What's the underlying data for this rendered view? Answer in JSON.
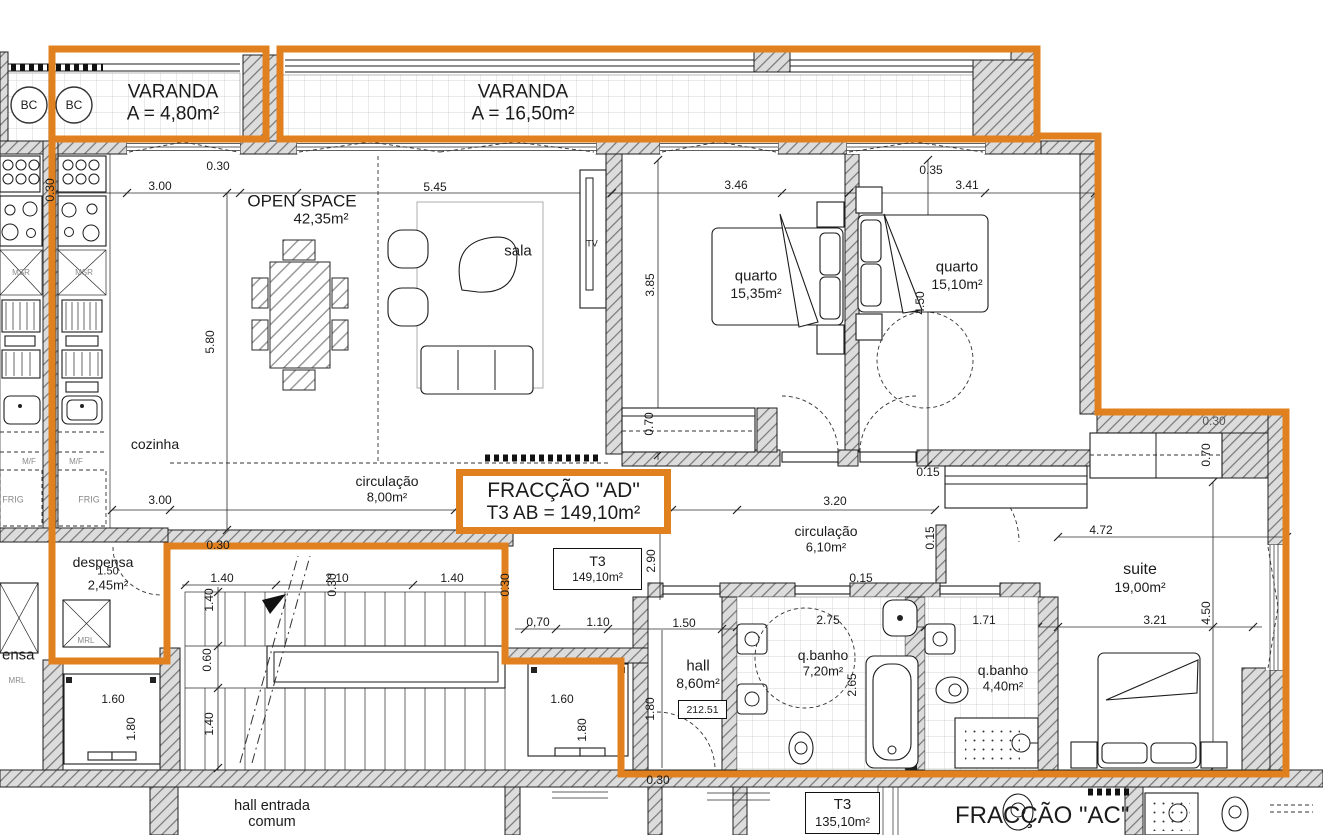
{
  "drawing": {
    "type": "apartment floor plan",
    "fraction_ad": {
      "line1": "FRACÇÃO \"AD\"",
      "line2": "T3  AB = 149,10m²"
    },
    "t3_tag": {
      "line1": "T3",
      "line2": "149,10m²"
    },
    "t3_lower_tag": {
      "line1": "T3",
      "line2": "135,10m²"
    },
    "level_mark": "212.51",
    "fraccao_ac": "FRACÇÃO \"AC\"",
    "common_hall": {
      "line1": "hall entrada",
      "line2": "comum"
    },
    "colors": {
      "boundary_orange": "#e0801f",
      "wall_hatch": "#dcdcdc",
      "line": "#1c1c1c"
    }
  },
  "labels": [
    {
      "id": "varanda-left-name",
      "text": "VARANDA",
      "x": 173,
      "y": 92,
      "size": 19
    },
    {
      "id": "varanda-left-area",
      "text": "A = 4,80m²",
      "x": 173,
      "y": 114,
      "size": 19
    },
    {
      "id": "varanda-main-name",
      "text": "VARANDA",
      "x": 523,
      "y": 92,
      "size": 19
    },
    {
      "id": "varanda-main-area",
      "text": "A = 16,50m²",
      "x": 523,
      "y": 114,
      "size": 19
    },
    {
      "id": "open-space-name",
      "text": "OPEN SPACE",
      "x": 302,
      "y": 201,
      "size": 17
    },
    {
      "id": "open-space-area",
      "text": "42,35m²",
      "x": 321,
      "y": 219,
      "size": 15
    },
    {
      "id": "sala-label",
      "text": "sala",
      "x": 518,
      "y": 251,
      "size": 15
    },
    {
      "id": "tv-label",
      "text": "TV",
      "x": 592,
      "y": 244,
      "size": 9
    },
    {
      "id": "quarto1-name",
      "text": "quarto",
      "x": 756,
      "y": 276,
      "size": 15
    },
    {
      "id": "quarto1-area",
      "text": "15,35m²",
      "x": 756,
      "y": 293,
      "size": 14
    },
    {
      "id": "quarto2-name",
      "text": "quarto",
      "x": 957,
      "y": 267,
      "size": 15
    },
    {
      "id": "quarto2-area",
      "text": "15,10m²",
      "x": 957,
      "y": 284,
      "size": 14
    },
    {
      "id": "cozinha-label",
      "text": "cozinha",
      "x": 155,
      "y": 444,
      "size": 14
    },
    {
      "id": "circulacao1-name",
      "text": "circulação",
      "x": 387,
      "y": 481,
      "size": 14
    },
    {
      "id": "circulacao1-area",
      "text": "8,00m²",
      "x": 387,
      "y": 497,
      "size": 13
    },
    {
      "id": "circulacao2-name",
      "text": "circulação",
      "x": 826,
      "y": 531,
      "size": 14
    },
    {
      "id": "circulacao2-area",
      "text": "6,10m²",
      "x": 826,
      "y": 547,
      "size": 13
    },
    {
      "id": "despensa-name",
      "text": "despensa",
      "x": 103,
      "y": 562,
      "size": 14
    },
    {
      "id": "despensa-area",
      "text": "2,45m²",
      "x": 108,
      "y": 585,
      "size": 13
    },
    {
      "id": "despensa-neighbor",
      "text": "ensa",
      "x": 2,
      "y": 655,
      "size": 15,
      "anchor": "left"
    },
    {
      "id": "hall-name",
      "text": "hall",
      "x": 698,
      "y": 666,
      "size": 15
    },
    {
      "id": "hall-area",
      "text": "8,60m²",
      "x": 698,
      "y": 683,
      "size": 14
    },
    {
      "id": "banho1-name",
      "text": "q.banho",
      "x": 823,
      "y": 655,
      "size": 14
    },
    {
      "id": "banho1-area",
      "text": "7,20m²",
      "x": 823,
      "y": 671,
      "size": 13
    },
    {
      "id": "banho2-name",
      "text": "q.banho",
      "x": 1003,
      "y": 670,
      "size": 14
    },
    {
      "id": "banho2-area",
      "text": "4,40m²",
      "x": 1003,
      "y": 686,
      "size": 13
    },
    {
      "id": "suite-name",
      "text": "suite",
      "x": 1140,
      "y": 570,
      "size": 16
    },
    {
      "id": "suite-area",
      "text": "19,00m²",
      "x": 1140,
      "y": 587,
      "size": 14
    },
    {
      "id": "bc-circle-left-label",
      "text": "BC",
      "x": 29,
      "y": 105,
      "size": 12
    },
    {
      "id": "bc-circle-right-label",
      "text": "BC",
      "x": 74,
      "y": 105,
      "size": 12
    },
    {
      "id": "mrl-label-1",
      "text": "MRL",
      "x": 86,
      "y": 641,
      "size": 8,
      "color": "#8a8a8a"
    },
    {
      "id": "mrl-label-2",
      "text": "MRL",
      "x": 17,
      "y": 681,
      "size": 8,
      "color": "#8a8a8a"
    },
    {
      "id": "msr-label-1",
      "text": "MSR",
      "x": 84,
      "y": 273,
      "size": 8,
      "color": "#8a8a8a"
    },
    {
      "id": "msr-label-2",
      "text": "MSR",
      "x": 21,
      "y": 273,
      "size": 8,
      "color": "#8a8a8a"
    },
    {
      "id": "mf-label-1",
      "text": "M/F",
      "x": 76,
      "y": 462,
      "size": 8,
      "color": "#8a8a8a"
    },
    {
      "id": "mf-label-2",
      "text": "M/F",
      "x": 29,
      "y": 462,
      "size": 8,
      "color": "#8a8a8a"
    },
    {
      "id": "frig-label-1",
      "text": "FRIG",
      "x": 89,
      "y": 500,
      "size": 9,
      "color": "#8a8a8a"
    },
    {
      "id": "frig-label-2",
      "text": "FRIG",
      "x": 13,
      "y": 500,
      "size": 9,
      "color": "#8a8a8a"
    },
    {
      "id": "dim-top-300",
      "text": "3.00",
      "x": 160,
      "y": 186
    },
    {
      "id": "dim-top-030",
      "text": "0.30",
      "x": 218,
      "y": 166
    },
    {
      "id": "dim-top-545",
      "text": "5.45",
      "x": 435,
      "y": 187
    },
    {
      "id": "dim-top-346",
      "text": "3.46",
      "x": 736,
      "y": 185
    },
    {
      "id": "dim-top-035",
      "text": "0.35",
      "x": 931,
      "y": 170
    },
    {
      "id": "dim-top-341",
      "text": "3.41",
      "x": 967,
      "y": 185
    },
    {
      "id": "dim-580",
      "text": "5.80",
      "x": 210,
      "y": 342,
      "rot": 1
    },
    {
      "id": "dim-385",
      "text": "3.85",
      "x": 650,
      "y": 285,
      "rot": 1
    },
    {
      "id": "dim-450-q2",
      "text": "4.50",
      "x": 920,
      "y": 303,
      "rot": 1
    },
    {
      "id": "dim-070-q1",
      "text": "0.70",
      "x": 649,
      "y": 424,
      "rot": 1
    },
    {
      "id": "dim-030-left",
      "text": "0.30",
      "x": 50,
      "y": 190,
      "rot": 1
    },
    {
      "id": "dim-300-co",
      "text": "3.00",
      "x": 160,
      "y": 500
    },
    {
      "id": "dim-730",
      "text": "7.30",
      "x": 493,
      "y": 502,
      "size": 10
    },
    {
      "id": "dim-290",
      "text": "2.90",
      "x": 651,
      "y": 561,
      "rot": 1
    },
    {
      "id": "dim-030-desp",
      "text": "0.30",
      "x": 218,
      "y": 545
    },
    {
      "id": "dim-030-stair",
      "text": "0.30",
      "x": 332,
      "y": 585,
      "rot": 1
    },
    {
      "id": "dim-030-elev",
      "text": "0.30",
      "x": 505,
      "y": 585,
      "rot": 1
    },
    {
      "id": "dim-140-a",
      "text": "1.40",
      "x": 222,
      "y": 578
    },
    {
      "id": "dim-210",
      "text": "2.10",
      "x": 337,
      "y": 578
    },
    {
      "id": "dim-140-b",
      "text": "1.40",
      "x": 452,
      "y": 578
    },
    {
      "id": "dim-140-v1",
      "text": "1.40",
      "x": 209,
      "y": 600,
      "rot": 1
    },
    {
      "id": "dim-060",
      "text": "0.60",
      "x": 207,
      "y": 660,
      "rot": 1
    },
    {
      "id": "dim-140-v2",
      "text": "1.40",
      "x": 209,
      "y": 724,
      "rot": 1
    },
    {
      "id": "dim-160-l",
      "text": "1.60",
      "x": 113,
      "y": 699
    },
    {
      "id": "dim-180-l",
      "text": "1.80",
      "x": 131,
      "y": 729,
      "rot": 1
    },
    {
      "id": "dim-160-r",
      "text": "1.60",
      "x": 562,
      "y": 699
    },
    {
      "id": "dim-180-r",
      "text": "1.80",
      "x": 582,
      "y": 730,
      "rot": 1
    },
    {
      "id": "dim-180-hall",
      "text": "1.80",
      "x": 650,
      "y": 709,
      "rot": 1
    },
    {
      "id": "dim-070-hall",
      "text": "0,70",
      "x": 538,
      "y": 622
    },
    {
      "id": "dim-110-hall",
      "text": "1.10",
      "x": 598,
      "y": 622
    },
    {
      "id": "dim-150-hall",
      "text": "1.50",
      "x": 684,
      "y": 623
    },
    {
      "id": "dim-150-desp",
      "text": "1.50",
      "x": 108,
      "y": 572,
      "size": 11
    },
    {
      "id": "dim-030-bottom",
      "text": "0.30",
      "x": 658,
      "y": 780
    },
    {
      "id": "dim-320",
      "text": "3.20",
      "x": 835,
      "y": 501
    },
    {
      "id": "dim-015-a",
      "text": "0.15",
      "x": 928,
      "y": 472
    },
    {
      "id": "dim-015-b",
      "text": "0.15",
      "x": 930,
      "y": 538,
      "rot": 1
    },
    {
      "id": "dim-015-c",
      "text": "0.15",
      "x": 861,
      "y": 578
    },
    {
      "id": "dim-472",
      "text": "4.72",
      "x": 1101,
      "y": 530
    },
    {
      "id": "dim-070-suite",
      "text": "0.70",
      "x": 1206,
      "y": 455,
      "rot": 1
    },
    {
      "id": "dim-030-suite",
      "text": "0.30",
      "x": 1214,
      "y": 421,
      "color": "#555"
    },
    {
      "id": "dim-321",
      "text": "3.21",
      "x": 1155,
      "y": 620
    },
    {
      "id": "dim-450-suite",
      "text": "4.50",
      "x": 1206,
      "y": 613,
      "rot": 1
    },
    {
      "id": "dim-275",
      "text": "2.75",
      "x": 828,
      "y": 620
    },
    {
      "id": "dim-265",
      "text": "2.65",
      "x": 852,
      "y": 685,
      "rot": 1
    },
    {
      "id": "dim-171",
      "text": "1.71",
      "x": 984,
      "y": 620
    }
  ]
}
